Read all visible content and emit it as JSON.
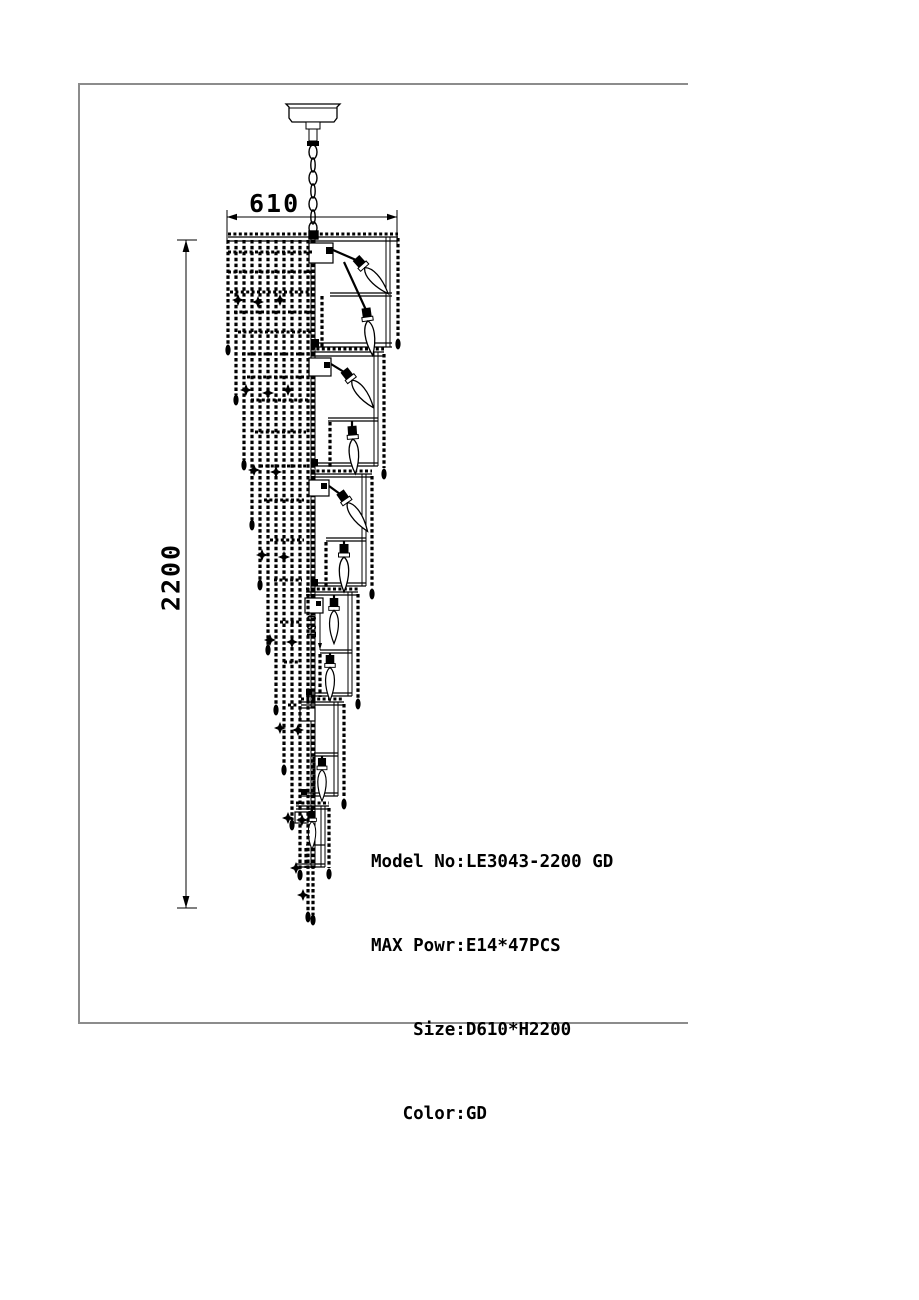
{
  "drawing": {
    "dim_width": "610",
    "dim_height": "2200",
    "dim_detail": "190",
    "specs": {
      "lines": [
        "Model No:LE3043-2200 GD",
        "MAX Powr:E14*47PCS",
        "    Size:D610*H2200",
        "   Color:GD"
      ]
    },
    "colors": {
      "ink": "#000000",
      "frame_border": "#8c8c8c",
      "background": "#ffffff"
    }
  }
}
